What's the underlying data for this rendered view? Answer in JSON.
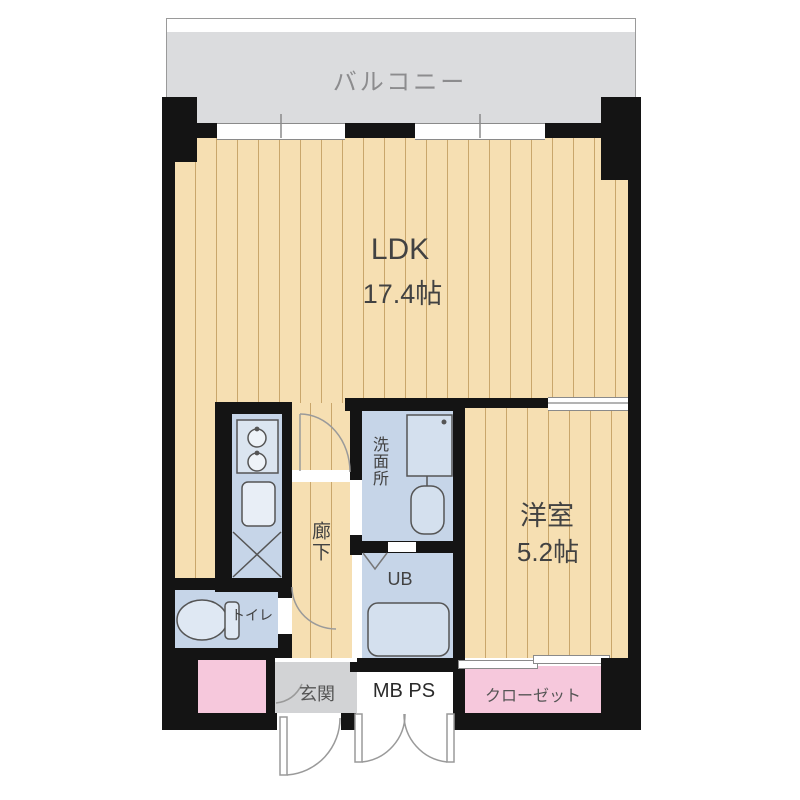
{
  "plan": {
    "title": "apartment-floor-plan",
    "rooms": {
      "balcony": {
        "label": "バルコニー"
      },
      "ldk": {
        "label": "LDK",
        "size": "17.4帖"
      },
      "western_room": {
        "label": "洋室",
        "size": "5.2帖"
      },
      "hallway": {
        "label": "廊下"
      },
      "washroom": {
        "label": "洗面所"
      },
      "unit_bath": {
        "label": "UB"
      },
      "meter_pipe_space": {
        "label": "MB PS"
      },
      "toilet": {
        "label": "トイレ"
      },
      "entrance": {
        "label": "玄関"
      },
      "closet": {
        "label": "クローゼット"
      }
    },
    "colors": {
      "wall": "#141414",
      "flooring": "#f6dfb2",
      "flooring_stripe": "#c9a66b",
      "water_room_blue": "#c6d5e8",
      "fixture_blue": "#dbe5f0",
      "pink": "#f6c8dc",
      "balcony_gray": "#dbdcde",
      "entrance_gray": "#d2d3d5"
    }
  }
}
